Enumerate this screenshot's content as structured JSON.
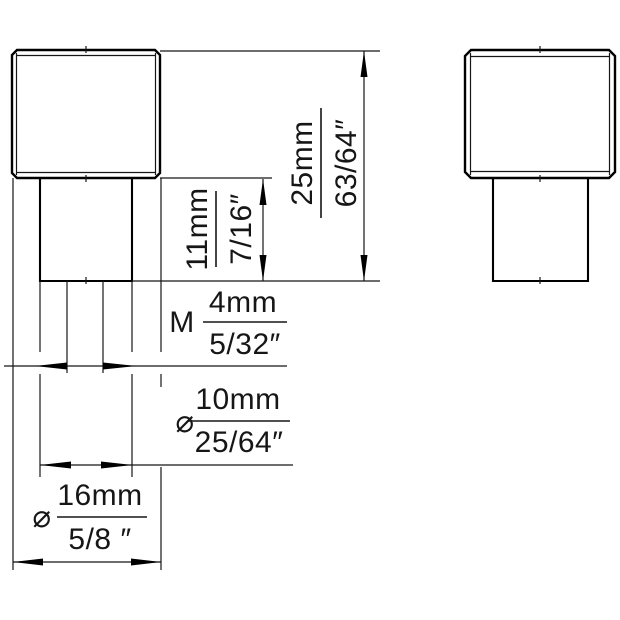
{
  "labels": {
    "total_height": {
      "mm": "25mm",
      "inch": "63/64″"
    },
    "stem_height": {
      "mm": "11mm",
      "inch": "7/16″"
    },
    "thread_size": {
      "prefix": "M",
      "mm": "4mm",
      "inch": "5/32″"
    },
    "stem_diameter": {
      "symbol": "⌀",
      "mm": "10mm",
      "inch": "25/64″"
    },
    "head_diameter": {
      "symbol": "⌀",
      "mm": "16mm",
      "inch": "5/8 ″"
    }
  },
  "colors": {
    "line": "#000000",
    "background": "#ffffff"
  }
}
